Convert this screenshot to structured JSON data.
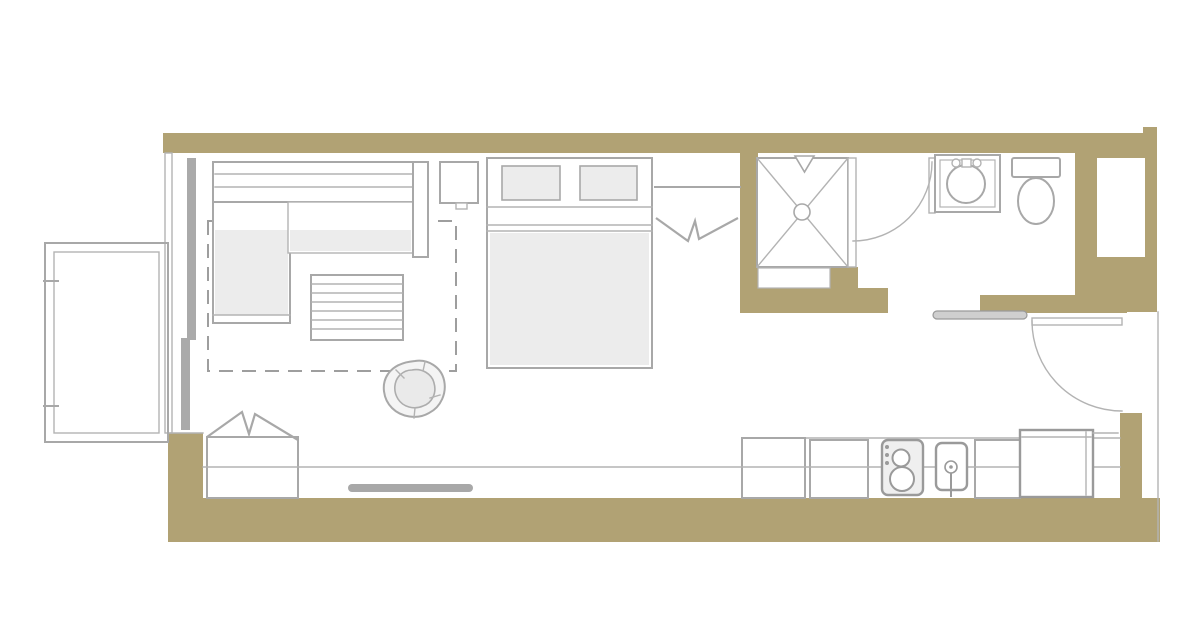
{
  "page": {
    "title": "Studio apartment floor plan"
  },
  "colors": {
    "background": "#ffffff",
    "wall": "#b1a274",
    "line": "#a8a8a8",
    "line_dark": "#9a9a9a",
    "furniture_fill": "#ececec",
    "appliance_fill": "#efefef",
    "plant_fill": "#eaeaea",
    "tv_fill": "#a8a8a8",
    "console_fill": "#cfcfcf",
    "panel_fill": "#aaaaaa",
    "white": "#ffffff"
  },
  "rooms": [
    "living-sleeping-area",
    "bathroom",
    "kitchen",
    "entry-hall",
    "balcony"
  ],
  "fixtures": [
    "sectional-sofa",
    "coffee-table",
    "side-table",
    "area-rug",
    "potted-plant",
    "double-bed",
    "pillows",
    "bedside-wardrobe",
    "entry-wardrobe",
    "tv",
    "sliding-balcony-door",
    "balcony-railing",
    "shower-stall",
    "shower-head",
    "shower-partition",
    "bathroom-door",
    "vanity-sink",
    "toilet",
    "utility-shaft",
    "entry-door",
    "entry-console",
    "kitchen-counter",
    "base-cabinets",
    "cooktop",
    "kitchen-sink",
    "refrigerator"
  ]
}
